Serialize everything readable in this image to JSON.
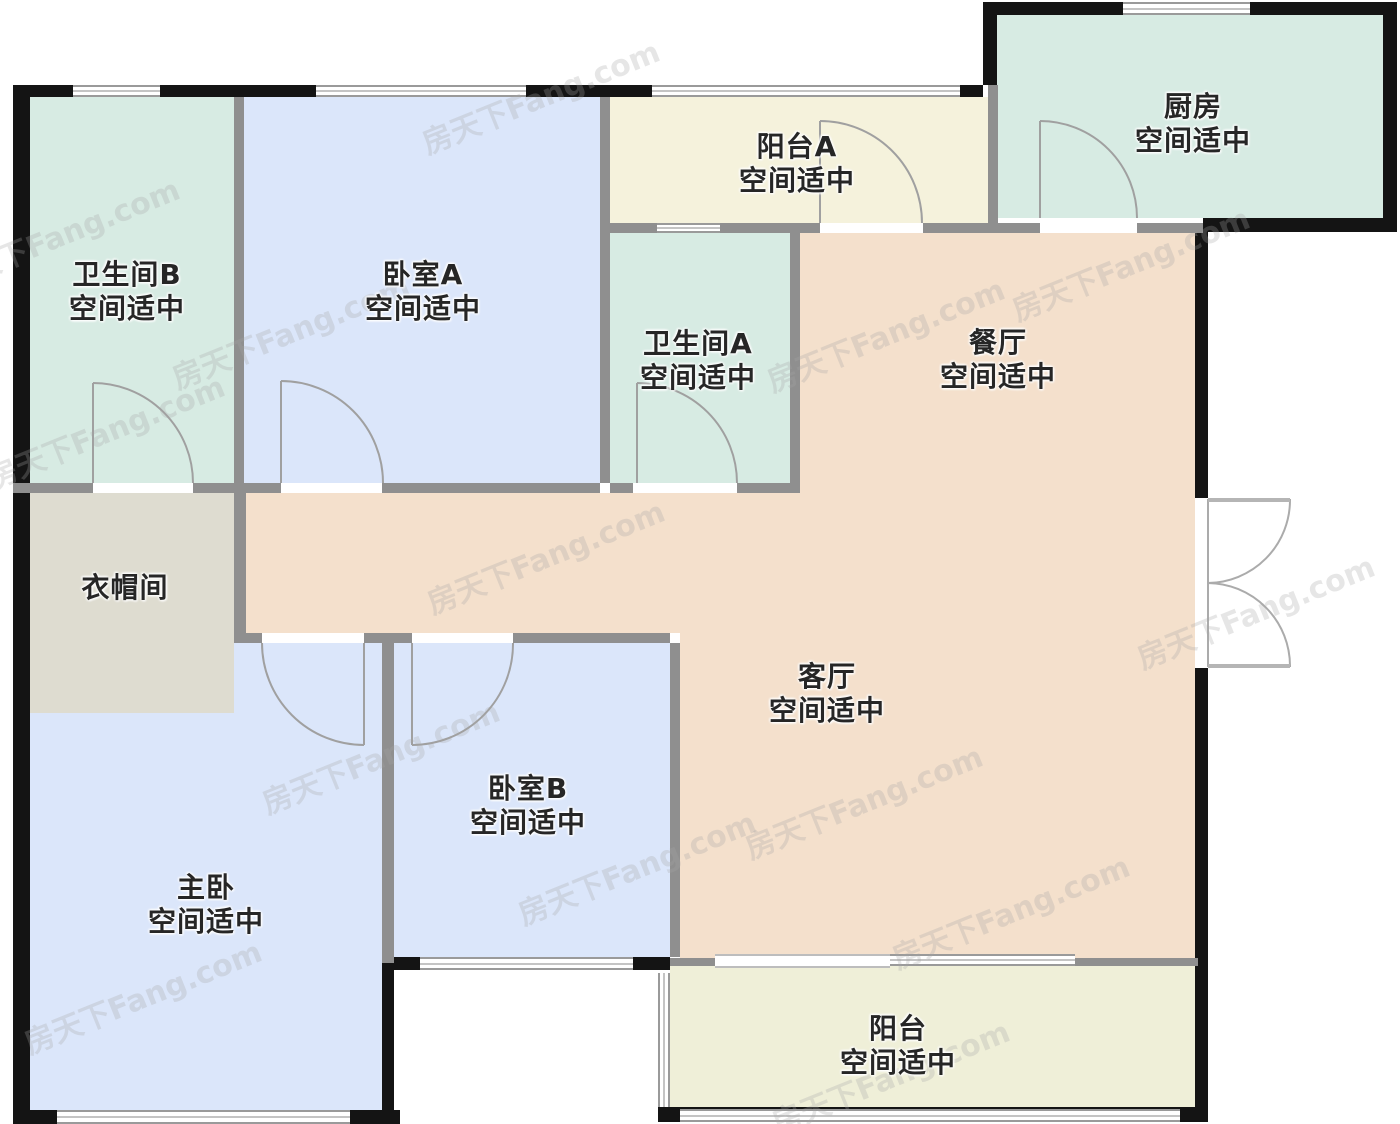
{
  "plan_title": "户型图",
  "watermark": {
    "text": "房天下Fang.com"
  },
  "colors": {
    "room_green": "#d7ebe3",
    "room_blue": "#dbe6fa",
    "room_yellow": "#f5f2dc",
    "room_peach": "#f4e0cc",
    "room_beige": "#dedcd0",
    "wall_black": "#141414",
    "wall_gray": "#8f8f8f"
  },
  "rooms": [
    {
      "id": "kitchen",
      "name": "厨房",
      "status": "空间适中"
    },
    {
      "id": "balcony_a",
      "name": "阳台A",
      "status": "空间适中"
    },
    {
      "id": "bathroom_b",
      "name": "卫生间B",
      "status": "空间适中"
    },
    {
      "id": "bedroom_a",
      "name": "卧室A",
      "status": "空间适中"
    },
    {
      "id": "bathroom_a",
      "name": "卫生间A",
      "status": "空间适中"
    },
    {
      "id": "dining",
      "name": "餐厅",
      "status": "空间适中"
    },
    {
      "id": "cloakroom",
      "name": "衣帽间",
      "status": ""
    },
    {
      "id": "living",
      "name": "客厅",
      "status": "空间适中"
    },
    {
      "id": "bedroom_b",
      "name": "卧室B",
      "status": "空间适中"
    },
    {
      "id": "master",
      "name": "主卧",
      "status": "空间适中"
    },
    {
      "id": "balcony",
      "name": "阳台",
      "status": "空间适中"
    }
  ]
}
